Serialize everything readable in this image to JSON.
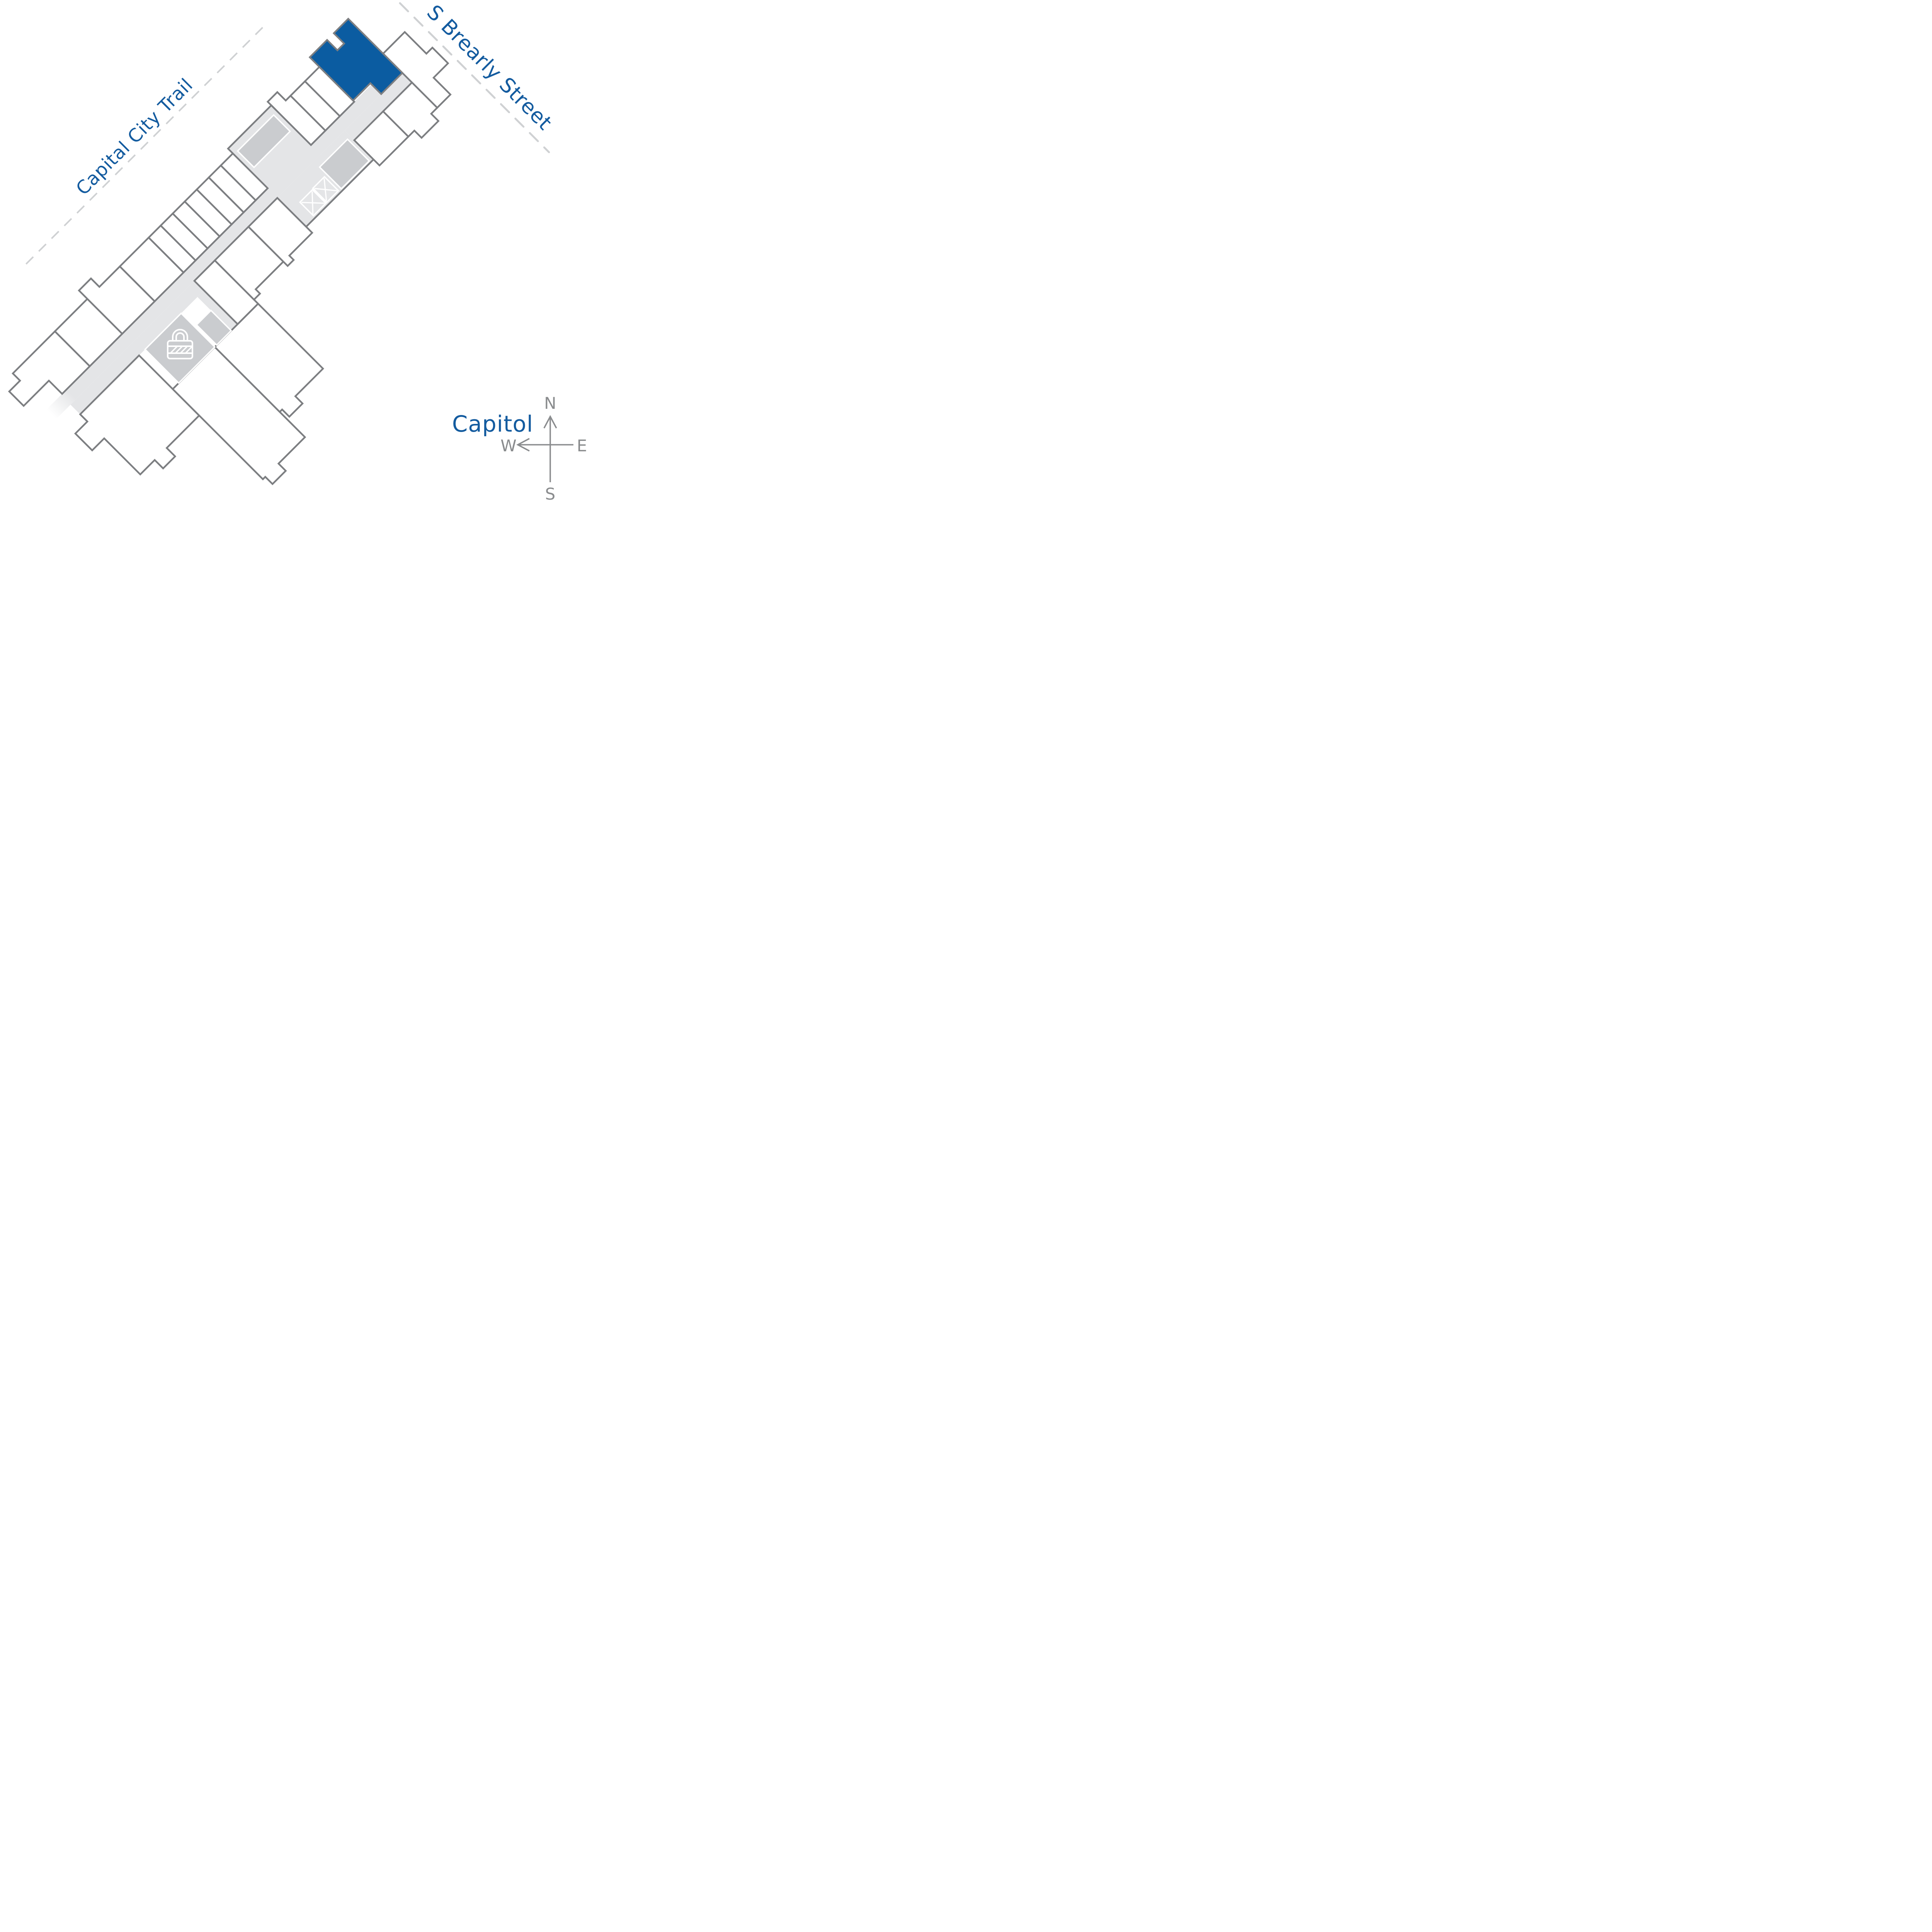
{
  "page": {
    "title": "Building site plan with highlighted unit"
  },
  "labels": {
    "trail": "Capital City Trail",
    "street": "S Brearly Street",
    "capitol": "Capitol"
  },
  "compass": {
    "north": "N",
    "south": "S",
    "east": "E",
    "west": "W"
  },
  "colors": {
    "accent_blue": "#0B5CA1",
    "label_blue": "#135B9F",
    "wall_gray": "#7C7E81",
    "corridor_gray": "#E4E5E7",
    "room_gray": "#CACCCF",
    "dash_gray": "#CFD1D3",
    "compass_gray": "#8A8C8E",
    "unit_white": "#FFFFFF"
  },
  "icons": [
    {
      "name": "lock-icon"
    },
    {
      "name": "stair-core-x-icon"
    },
    {
      "name": "compass-rose-icon"
    }
  ],
  "highlighted_unit": {
    "state": "selected",
    "fill": "#0B5CA1"
  }
}
